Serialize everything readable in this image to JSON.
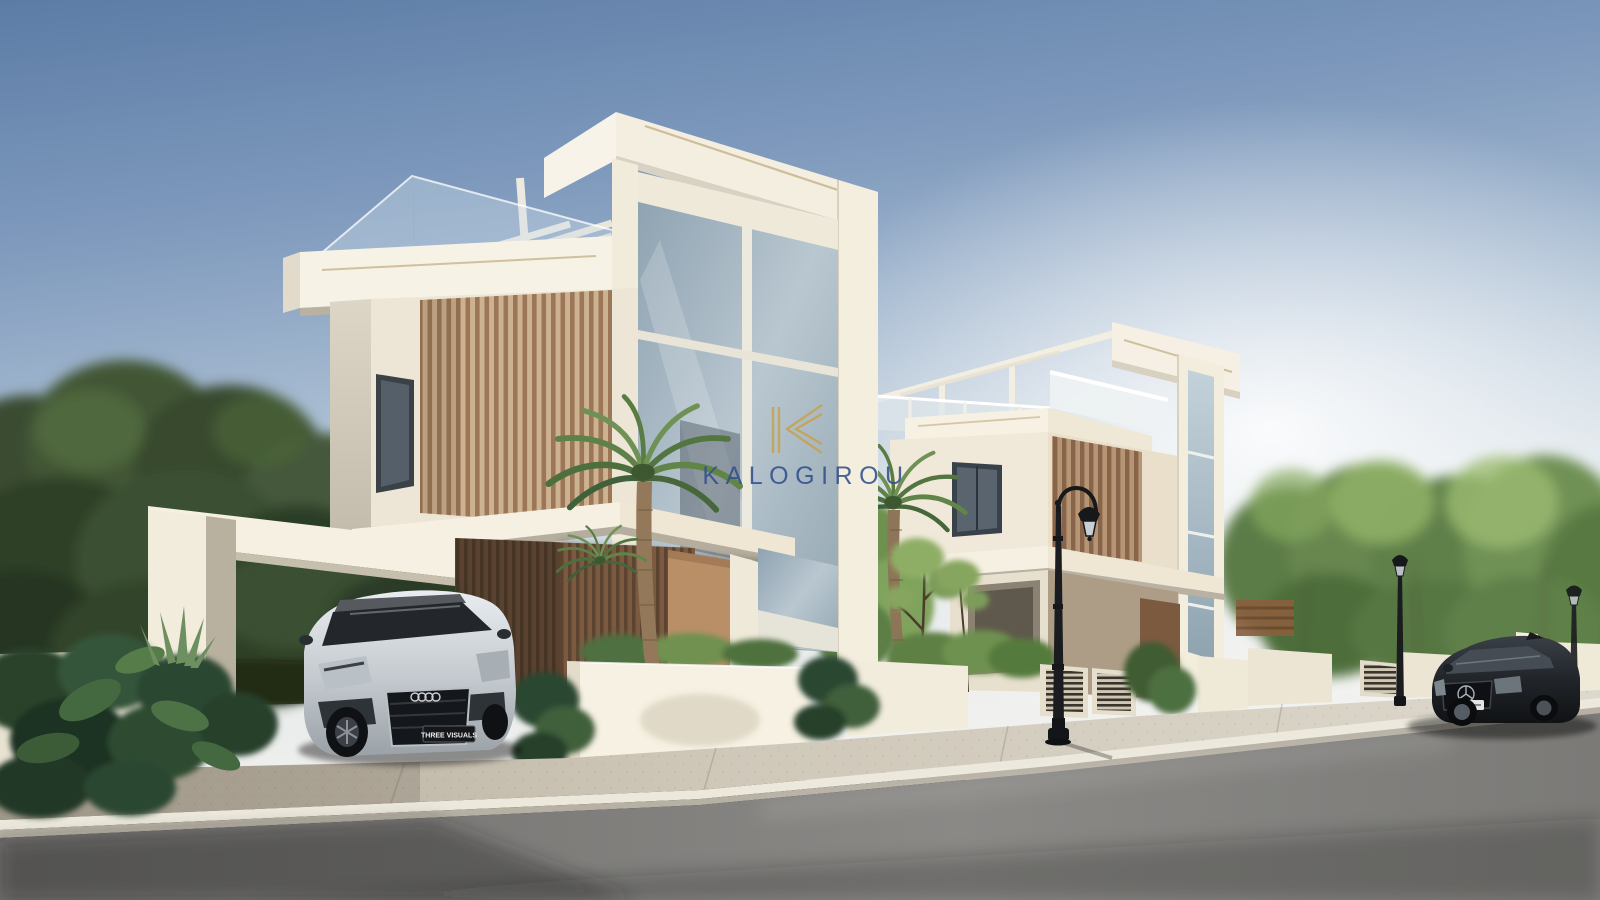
{
  "watermark": {
    "brand_text": "KALOGIROU",
    "logo": "kalogirou-k-monogram",
    "text_color": "#31508c",
    "logo_color": "#c7a24b"
  },
  "vehicles": {
    "silver_car_plate": "THREE VISUALS"
  },
  "palette": {
    "sky_top": "#5c7ca6",
    "sky_horizon": "#f4f4f1",
    "wall_light": "#f6f1e3",
    "wall_shade": "#d6cfc0",
    "wood_slat_light": "#c9a987",
    "wood_slat_dark": "#9b7758",
    "wood_wall": "#7a5a41",
    "glass": "#9fb3c0",
    "road": "#7e7d7a",
    "sidewalk": "#cfc8b9",
    "foliage_dark": "#3c4f33",
    "foliage_bright": "#7d9c5a",
    "lamp_black": "#17181a",
    "gold_trim": "#c8b48e"
  }
}
